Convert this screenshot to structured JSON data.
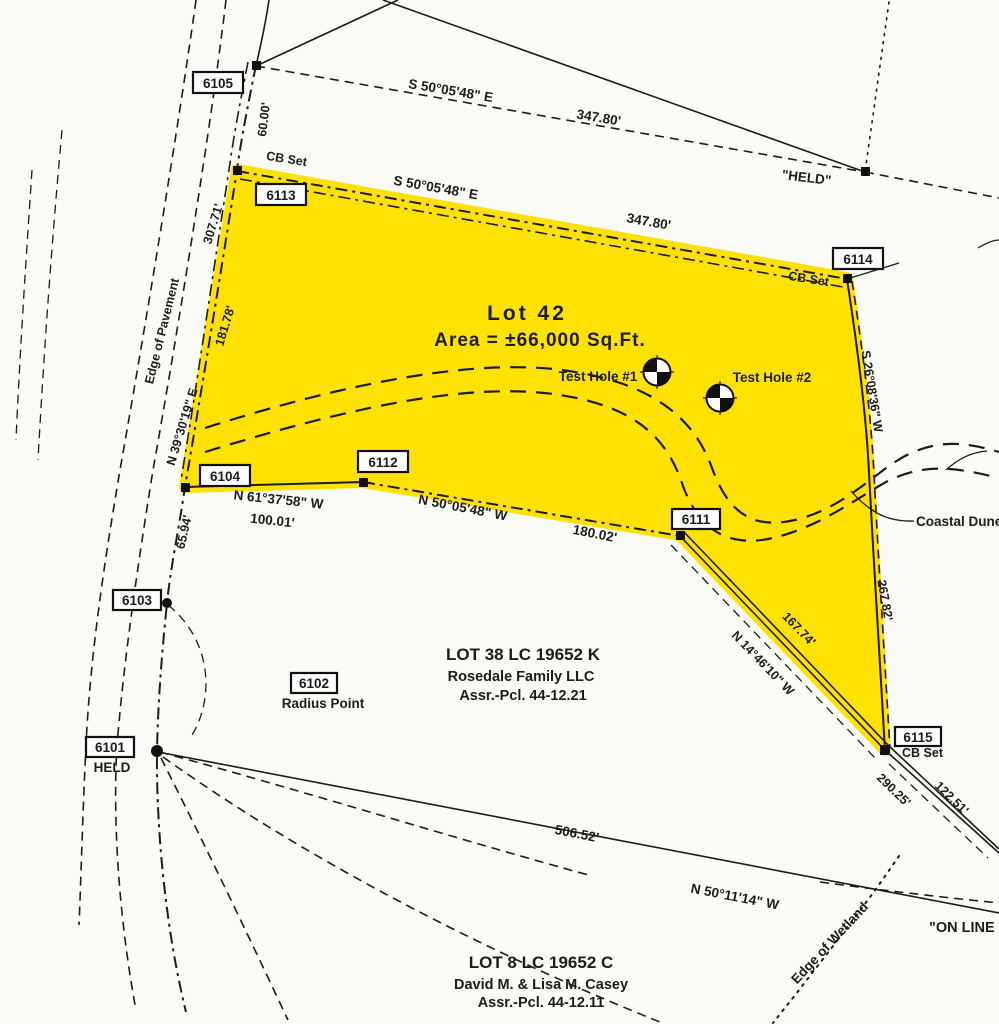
{
  "colors": {
    "highlight": "#ffe103",
    "line": "#1c1c1c",
    "background": "#fbfbf7"
  },
  "lot": {
    "name": "Lot 42",
    "area": "Area = ±66,000 Sq.Ft."
  },
  "points": {
    "p6101": {
      "id": "6101",
      "note": "HELD"
    },
    "p6102": {
      "id": "6102",
      "note": "Radius Point"
    },
    "p6103": {
      "id": "6103"
    },
    "p6104": {
      "id": "6104"
    },
    "p6105": {
      "id": "6105"
    },
    "p6111": {
      "id": "6111"
    },
    "p6112": {
      "id": "6112"
    },
    "p6113": {
      "id": "6113",
      "note": "CB Set"
    },
    "p6114": {
      "id": "6114",
      "note": "CB Set"
    },
    "p6115": {
      "id": "6115",
      "note": "CB Set"
    }
  },
  "bearings": {
    "top_outer": {
      "bearing": "S 50°05'48\" E",
      "distance": "347.80'"
    },
    "top_lot": {
      "bearing": "S 50°05'48\" E",
      "distance": "347.80'"
    },
    "frontage": {
      "bearing": "N 39°30'19\" E",
      "distance": "181.78'"
    },
    "pavement": {
      "distance": "307.71'"
    },
    "seg_6105": {
      "distance": "60.00'"
    },
    "sw": {
      "bearing": "N 61°37'58\" W",
      "distance": "100.01'"
    },
    "seg_6103": {
      "distance": "65.94'"
    },
    "south": {
      "bearing": "N 50°05'48\" W",
      "distance": "180.02'"
    },
    "east": {
      "bearing": "S 26°08'36\" W",
      "distance": "267.82'"
    },
    "se": {
      "bearing": "N 14°46'10\" W",
      "distance": "167.74'"
    },
    "se_ext": {
      "distance1": "290.25'",
      "distance2": "122.51'"
    },
    "bottom": {
      "bearing": "N 50°11'14\" W",
      "distance": "506.52'"
    }
  },
  "features": {
    "edge_of_pavement": "Edge of Pavement",
    "edge_of_wetland": "Edge of Wetland",
    "coastal": "Coastal Dune",
    "on_line": "\"ON LINE",
    "held_top": "\"HELD\"",
    "test_hole_1": "Test Hole #1",
    "test_hole_2": "Test Hole #2"
  },
  "parcels": {
    "lot38": {
      "line1": "LOT 38   LC 19652 K",
      "line2": "Rosedale Family LLC",
      "line3": "Assr.-Pcl. 44-12.21"
    },
    "lot8": {
      "line1": "LOT 8   LC 19652 C",
      "line2": "David M. & Lisa M. Casey",
      "line3": "Assr.-Pcl. 44-12.11"
    }
  }
}
